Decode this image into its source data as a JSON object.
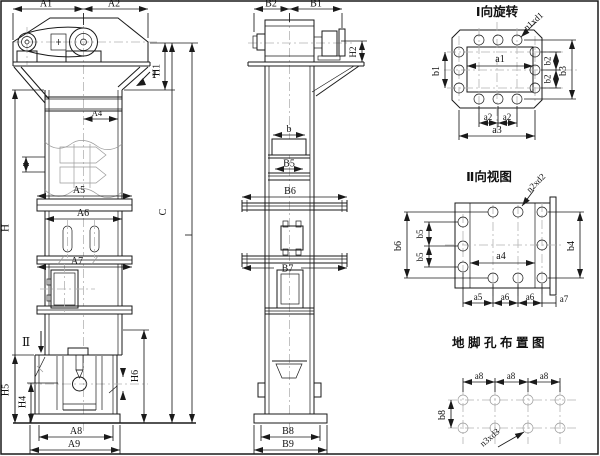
{
  "front_view": {
    "labels": {
      "A1": "A1",
      "A2": "A2",
      "A4": "A4",
      "A5": "A5",
      "A6": "A6",
      "A7": "A7",
      "A8": "A8",
      "A9": "A9",
      "H": "H",
      "H1": "H1",
      "H4": "H4",
      "H5": "H5",
      "H6": "H6",
      "C": "C",
      "view_marker_1": "Ⅰ",
      "view_marker_2": "Ⅱ"
    }
  },
  "side_view": {
    "labels": {
      "B1": "B1",
      "B2": "B2",
      "B5": "B5",
      "B6": "B6",
      "B7": "B7",
      "B8": "B8",
      "B9": "B9",
      "H2": "H2",
      "b": "b"
    }
  },
  "view_I": {
    "title": "Ⅰ向旋转",
    "hole_callout": "n1xd1",
    "labels": {
      "a1": "a1",
      "a2": "a2",
      "a3": "a3",
      "b1": "b1",
      "b2": "b2",
      "b3": "b3"
    }
  },
  "view_II": {
    "title": "Ⅱ向视图",
    "hole_callout": "n2xd2",
    "labels": {
      "a4": "a4",
      "a5": "a5",
      "a6": "a6",
      "a7": "a7",
      "b4": "b4",
      "b5": "b5",
      "b6": "b6"
    }
  },
  "anchor_plan": {
    "title": "地脚孔布置图",
    "hole_callout": "n3xd3",
    "labels": {
      "a8": "a8",
      "b8": "b8"
    }
  },
  "colors": {
    "line": "#1a1a1a",
    "centerline": "#b4b4b4",
    "background": "#ffffff"
  }
}
